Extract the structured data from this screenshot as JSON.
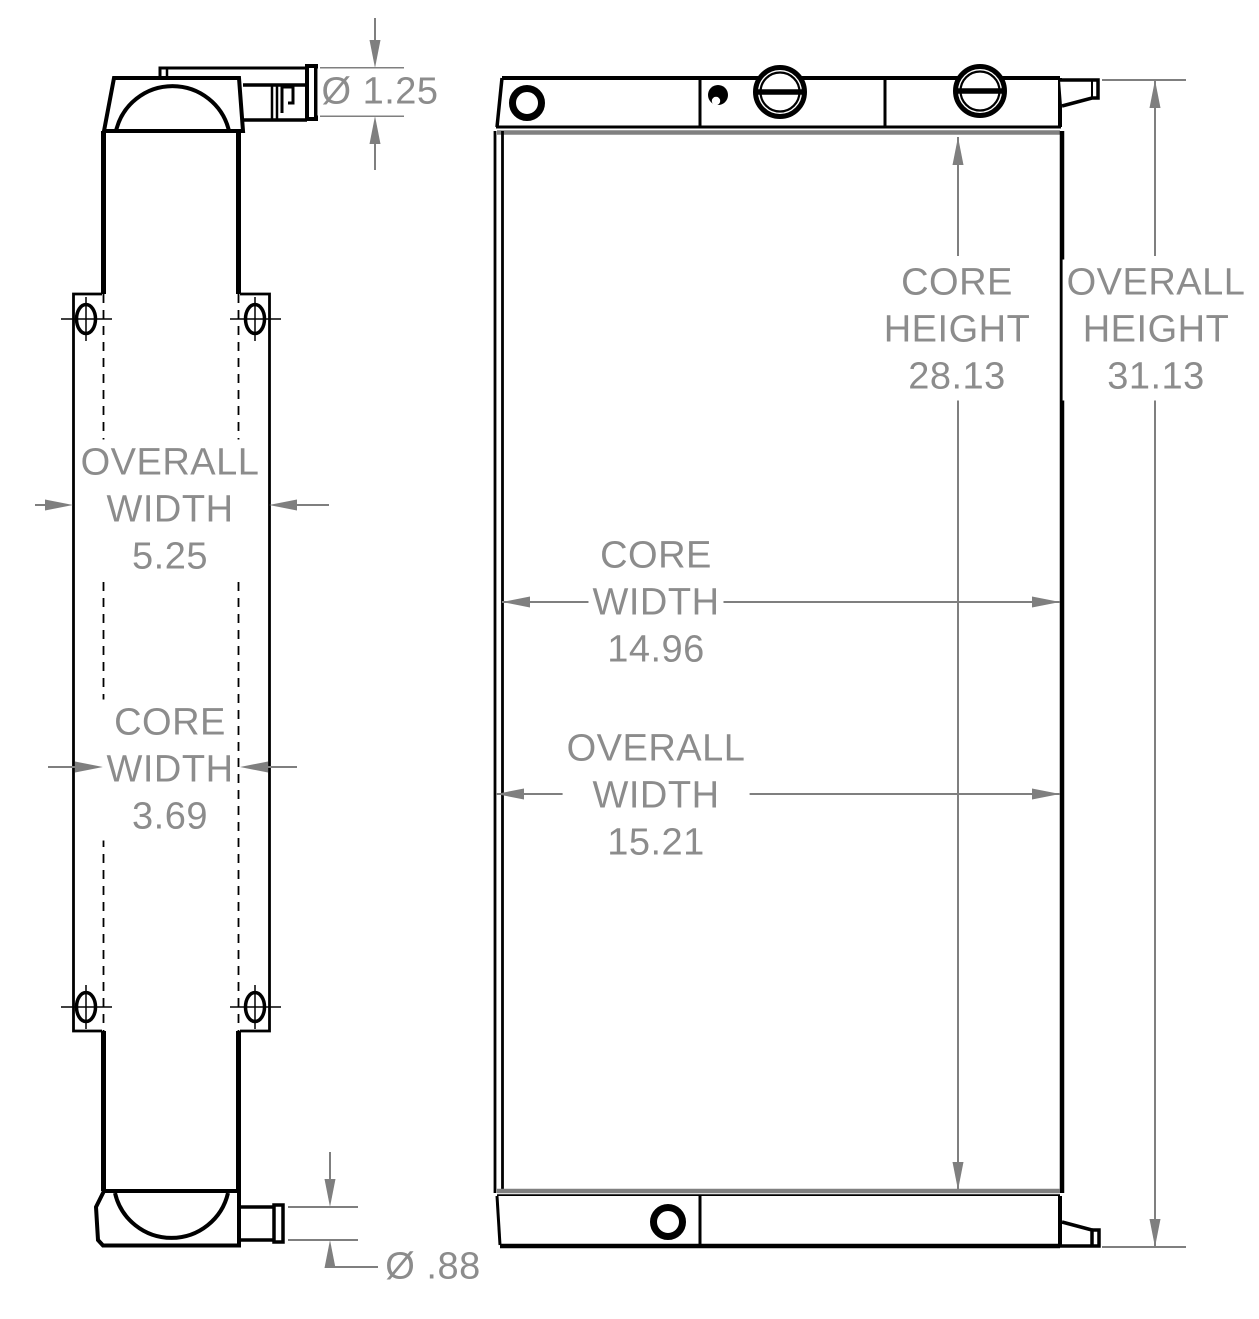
{
  "drawing_title": "radiator-dimension-drawing",
  "colors": {
    "background": "#ffffff",
    "outline": "#000000",
    "dimension_line": "#7f7f7f",
    "dimension_text": "#8c8c8c",
    "seam_line": "#808080"
  },
  "labels": {
    "side_top_port_diameter": {
      "text": "Ø 1.25"
    },
    "side_overall_width": {
      "line1": "OVERALL",
      "line2": "WIDTH",
      "value": "5.25"
    },
    "side_core_width": {
      "line1": "CORE",
      "line2": "WIDTH",
      "value": "3.69"
    },
    "side_bottom_port_diameter": {
      "text": "Ø .88"
    },
    "front_core_height": {
      "line1": "CORE",
      "line2": "HEIGHT",
      "value": "28.13"
    },
    "front_overall_height": {
      "line1": "OVERALL",
      "line2": "HEIGHT",
      "value": "31.13"
    },
    "front_core_width": {
      "line1": "CORE",
      "line2": "WIDTH",
      "value": "14.96"
    },
    "front_overall_width": {
      "line1": "OVERALL",
      "line2": "WIDTH",
      "value": "15.21"
    }
  }
}
